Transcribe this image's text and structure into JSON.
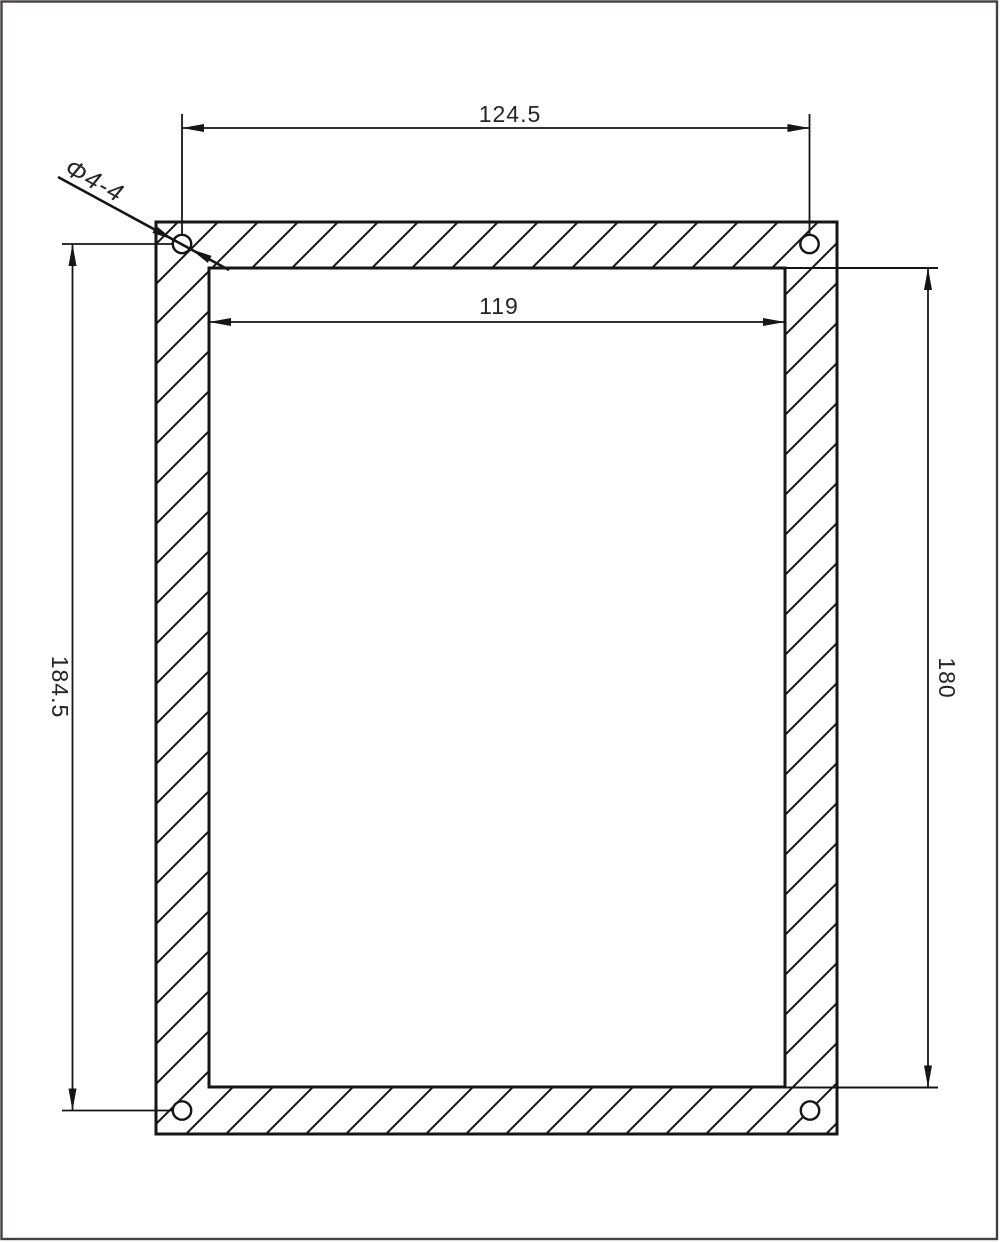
{
  "drawing": {
    "type": "panel-cutout-dimension-drawing",
    "dimensions": {
      "top_width": "124.5",
      "inner_width": "119",
      "left_height": "184.5",
      "right_height": "180",
      "hole_callout": "Φ4-4"
    },
    "colors": {
      "line": "#161414",
      "text": "#262424",
      "page_border": "#474040",
      "background": "#ffffff"
    }
  }
}
